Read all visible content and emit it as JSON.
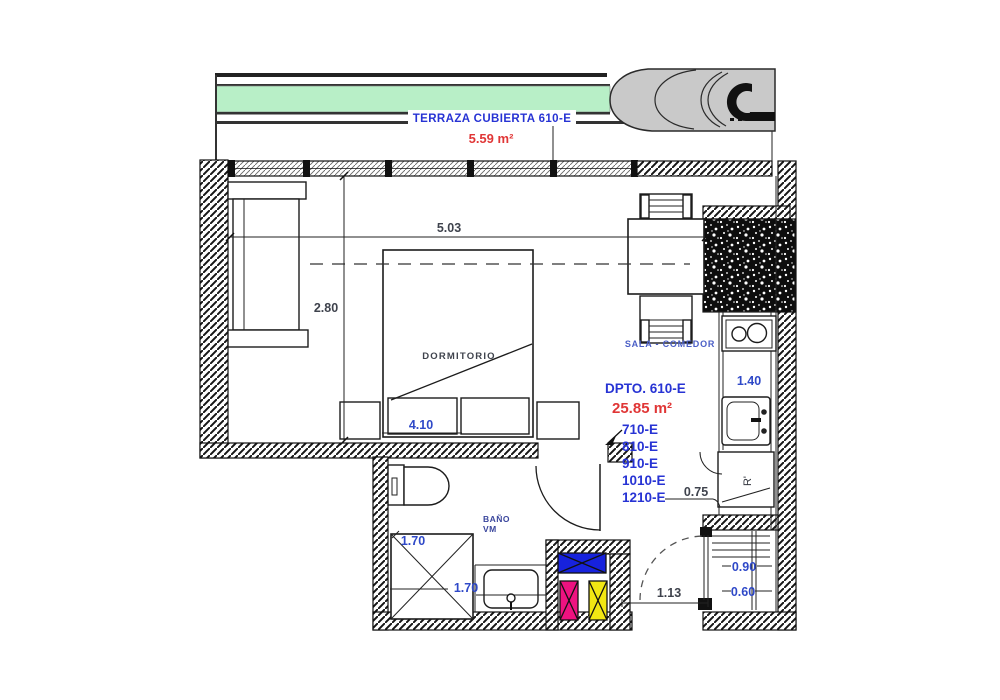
{
  "drawing": {
    "terrace": {
      "label": "TERRAZA CUBIERTA 610-E",
      "area": "5.59 m²"
    },
    "apartment": {
      "label": "DPTO. 610-E",
      "area": "25.85 m²",
      "other_units": [
        "710-E",
        "810-E",
        "910-E",
        "1010-E",
        "1210-E"
      ]
    },
    "rooms": {
      "bedroom": "DORMITORIO",
      "living_dining": "SALA - COMEDOR",
      "bathroom_line1": "BAÑO",
      "bathroom_line2": "VM"
    },
    "appliances": {
      "fridge": "R'"
    },
    "dims": {
      "top_width": "5.03",
      "left_height": "2.80",
      "bed_wall": "4.10",
      "kitchen_counter": "1.40",
      "hall": "0.75",
      "bath_a": "1.70",
      "bath_b": "1.70",
      "entry": "1.13",
      "stair_a": "0.90",
      "stair_b": "0.60"
    },
    "colors": {
      "terrace_green": "#b8efc7",
      "label_blue": "#2733d4",
      "area_red": "#e03636",
      "dim_blue": "#2f49c8",
      "sala_blue": "#4a5ec6",
      "bath_blue": "#39459c",
      "shaft_blue": "#1722dd",
      "shaft_magenta": "#ee1280",
      "shaft_yellow": "#f2e713"
    }
  }
}
